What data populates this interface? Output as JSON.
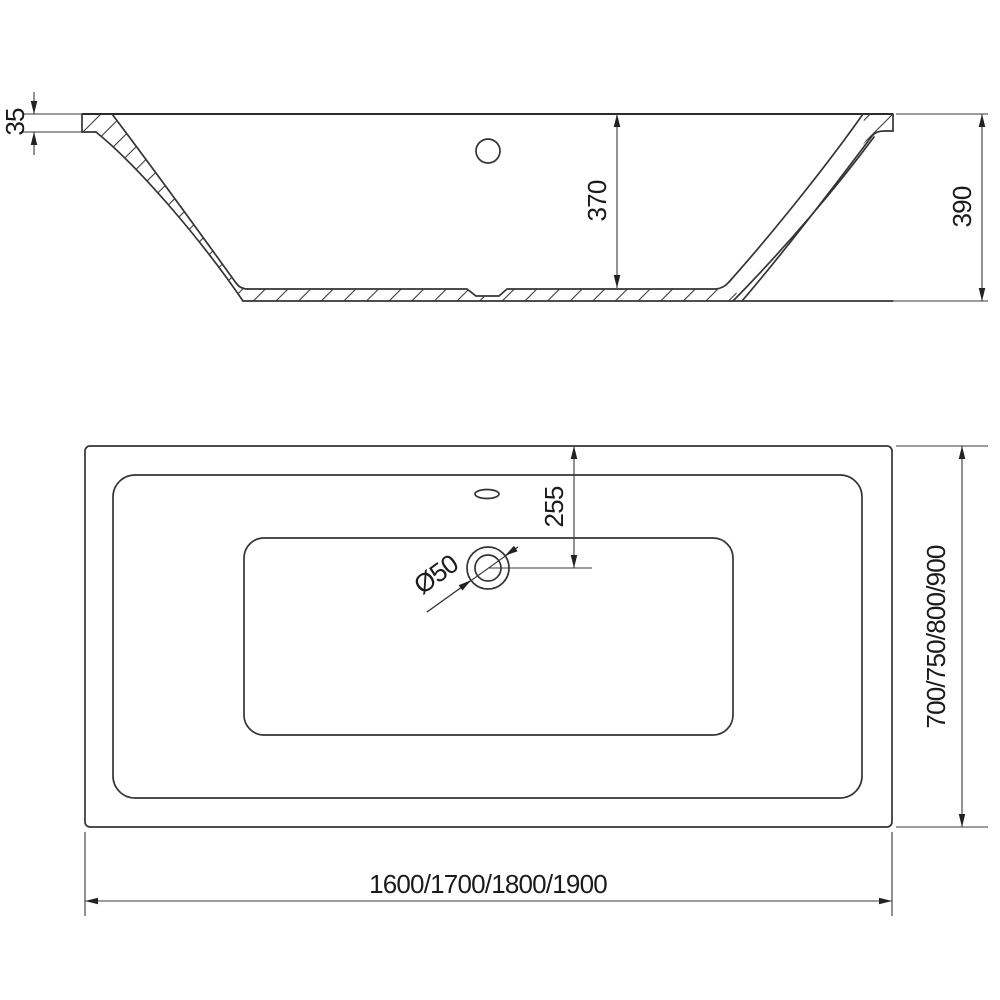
{
  "drawing": {
    "kind": "bathtub technical drawing, section and plan views",
    "colors": {
      "line": "#343434",
      "text": "#1b1b1b",
      "background": "#ffffff"
    },
    "side_view": {
      "dim_rim_thickness": "35",
      "dim_inner_depth": "370",
      "dim_overall_height": "390"
    },
    "plan_view": {
      "dim_drain_offset": "255",
      "dim_drain_diameter": "Ø50",
      "dim_length_options": "1600/1700/1800/1900",
      "dim_width_options": "700/750/800/900"
    }
  }
}
